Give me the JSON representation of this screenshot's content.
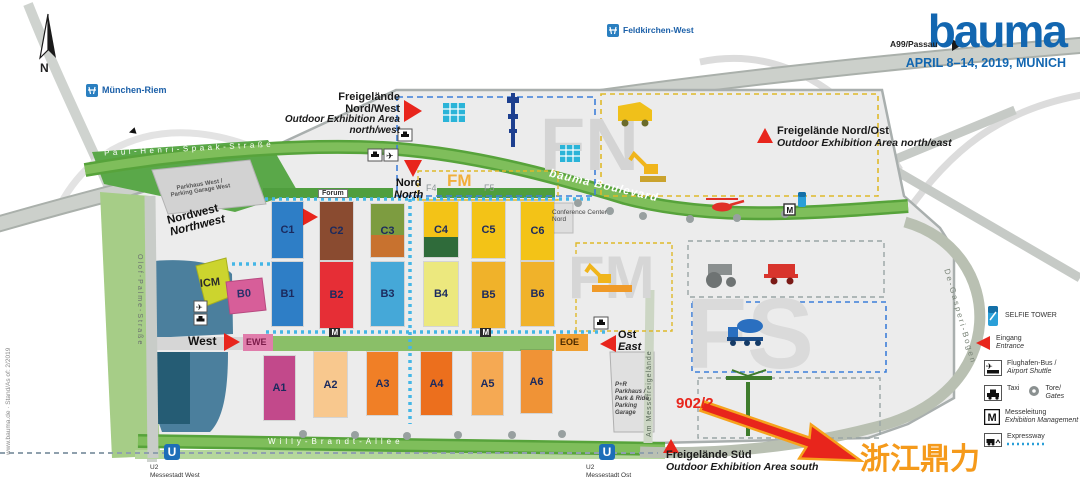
{
  "brand": {
    "logo": "bauma",
    "dates": "APRIL 8–14, 2019, MUNICH",
    "color": "#1266b0"
  },
  "compass": {
    "n": "N"
  },
  "highways": {
    "a94": "A94",
    "a99": "A99/Passau",
    "muenchen_riem": "München-Riem",
    "feldkirchen_west": "Feldkirchen-West",
    "muenchen_dir": "München"
  },
  "roads": {
    "paul_henri": "Paul-Henri-Spaak-Straße",
    "olof_palme": "Olof-Palme-Straße",
    "willy_brandt": "Willy-Brandt-Allee",
    "bauma_boulevard": "bauma Boulevard",
    "am_messefreigelaende": "Am Messefreigelände",
    "de_gasperi": "De-Gasperi-Bogen"
  },
  "areas": {
    "fn_letters": "FN",
    "fm_letters": "FM",
    "fs_letters": "FS",
    "fm_small": "FM",
    "f4": "F4",
    "f5": "F5",
    "nw": {
      "l1": "Freigelände",
      "l2": "Nord/West",
      "l3": "Outdoor Exhibition Area",
      "l4": "north/west"
    },
    "no": {
      "l1": "Freigelände Nord/Ost",
      "l2": "Outdoor Exhibition Area north/east"
    },
    "sued": {
      "l1": "Freigelände Süd",
      "l2": "Outdoor Exhibition Area south"
    }
  },
  "entrances": {
    "nordwest": {
      "de": "Nordwest",
      "en": "Northwest"
    },
    "nord": {
      "de": "Nord",
      "en": "North"
    },
    "west": {
      "de": "West"
    },
    "ost": {
      "de": "Ost",
      "en": "East"
    }
  },
  "halls": {
    "row_c": [
      {
        "id": "C1",
        "color": "#2e7ec6"
      },
      {
        "id": "C2",
        "color": "#8a4b30"
      },
      {
        "id": "C3",
        "color": "#7d9c40",
        "color2": "#c8722f"
      },
      {
        "id": "C4",
        "color": "#f3c317",
        "color2": "#2f6b3a"
      },
      {
        "id": "C5",
        "color": "#f3c317"
      },
      {
        "id": "C6",
        "color": "#f3c317"
      }
    ],
    "row_b": [
      {
        "id": "B1",
        "color": "#2e7ec6"
      },
      {
        "id": "B2",
        "color": "#e62e36"
      },
      {
        "id": "B3",
        "color": "#45a8d8"
      },
      {
        "id": "B4",
        "color": "#ece87e"
      },
      {
        "id": "B5",
        "color": "#f0b22a"
      },
      {
        "id": "B6",
        "color": "#f0b22a"
      }
    ],
    "row_a": [
      {
        "id": "A1",
        "color": "#c2498b"
      },
      {
        "id": "A2",
        "color": "#f8c88e"
      },
      {
        "id": "A3",
        "color": "#f07f26"
      },
      {
        "id": "A4",
        "color": "#ec6f1d"
      },
      {
        "id": "A5",
        "color": "#f5a953"
      },
      {
        "id": "A6",
        "color": "#f09336"
      }
    ]
  },
  "buildings": {
    "icm": "ICM",
    "b0": "B0",
    "ewe": "EWE",
    "eoe": "EOE",
    "forum": "Forum",
    "parkhaus_west_1": "Parkhaus West /",
    "parkhaus_west_2": "Parking Garage West",
    "conference_1": "Conference Center",
    "conference_2": "Nord",
    "pr_1": "P+R",
    "pr_2": "Parkhaus /",
    "pr_3": "Park & Ride",
    "pr_4": "Parking",
    "pr_5": "Garage"
  },
  "legend": {
    "selfie_tower": "SELFIE TOWER",
    "eingang": {
      "de": "Eingang",
      "en": "Entrance"
    },
    "airport": {
      "de": "Flughafen-Bus /",
      "en": "Airport Shuttle"
    },
    "taxi": "Taxi",
    "tore": {
      "de": "Tore/",
      "en": "Gates"
    },
    "messeleitung": {
      "de": "Messeleitung",
      "en": "Exhibition Management",
      "m": "M"
    },
    "expressway": "Expressway"
  },
  "transit": {
    "u_symbol": "U",
    "west_line": "U2",
    "west_name": "Messestadt West",
    "ost_line": "U2",
    "ost_name": "Messestadt Ost"
  },
  "annotation": {
    "booth": "902/2",
    "exhibitor": "浙江鼎力",
    "arrow_color": "#e8251c",
    "exhibitor_color": "#f59a1b",
    "booth_color": "#e8251c"
  },
  "footer": "www.bauma.de · Stand/As of: 2/2019"
}
